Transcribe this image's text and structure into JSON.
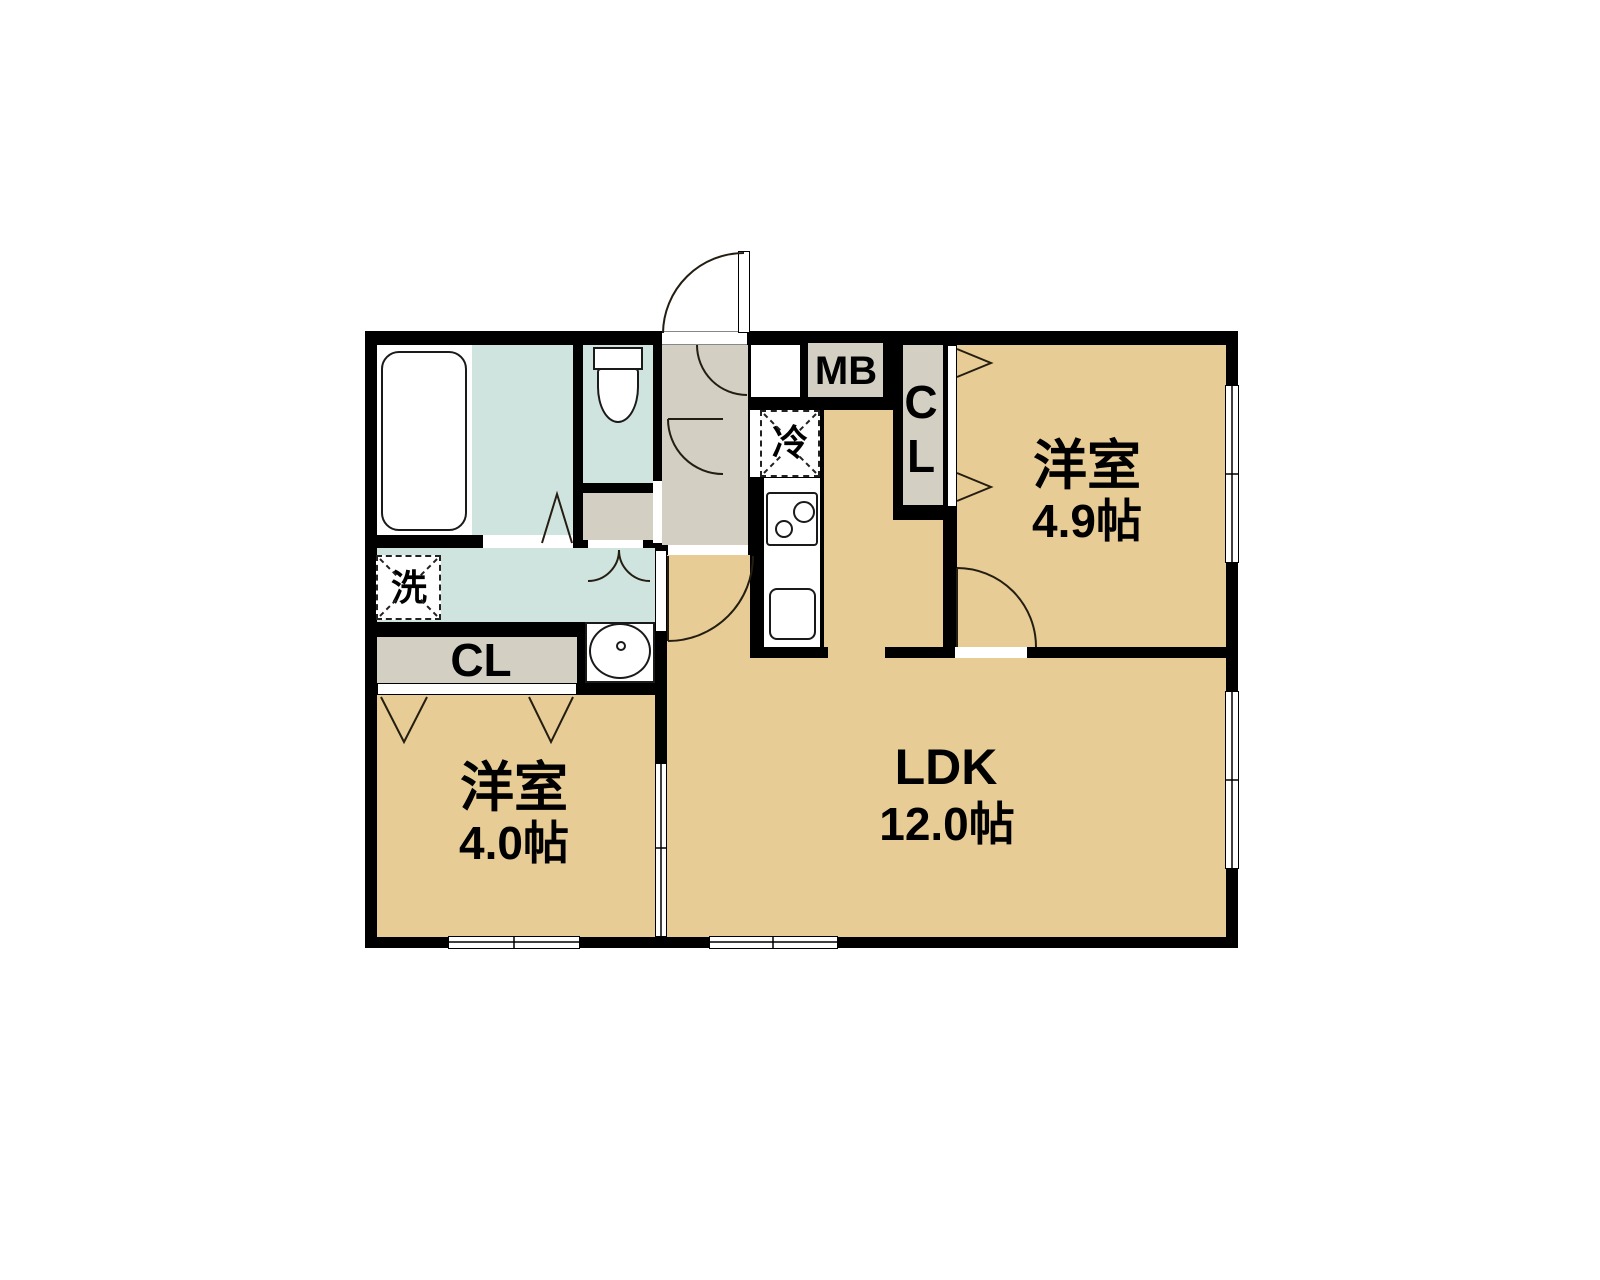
{
  "colors": {
    "room_floor": "#E8CC96",
    "wet_floor": "#CFE3DF",
    "hall_floor": "#D3CFC3",
    "wall": "#000000",
    "line": "#241E12"
  },
  "rooms": {
    "western_a": {
      "name": "洋室",
      "size": "4.9帖"
    },
    "western_b": {
      "name": "洋室",
      "size": "4.0帖"
    },
    "ldk": {
      "name": "LDK",
      "size": "12.0帖"
    }
  },
  "features": {
    "closet_upper": "CL",
    "closet_lower": "CL",
    "meter_box": "MB",
    "refrigerator": "冷",
    "washing_machine": "洗"
  }
}
